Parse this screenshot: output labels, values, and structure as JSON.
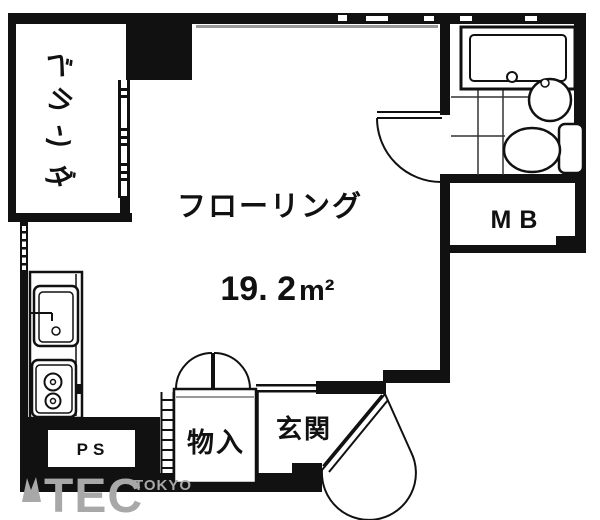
{
  "plan": {
    "main_room": {
      "label": "フローリング",
      "area_value": "19. 2",
      "area_unit": "m²"
    },
    "veranda_chars": [
      "ベ",
      "ラ",
      "ン",
      "ダ"
    ],
    "storage_label": "物入",
    "entrance_label": "玄関",
    "meter_box_label": "MB",
    "pipe_shaft_label": "PS"
  },
  "watermark": {
    "name": "TEC",
    "sub": "TOKYO"
  },
  "colors": {
    "wall": "#111111",
    "background": "#ffffff",
    "window_line": "#999999",
    "watermark_gray": "#a8a8a8"
  }
}
